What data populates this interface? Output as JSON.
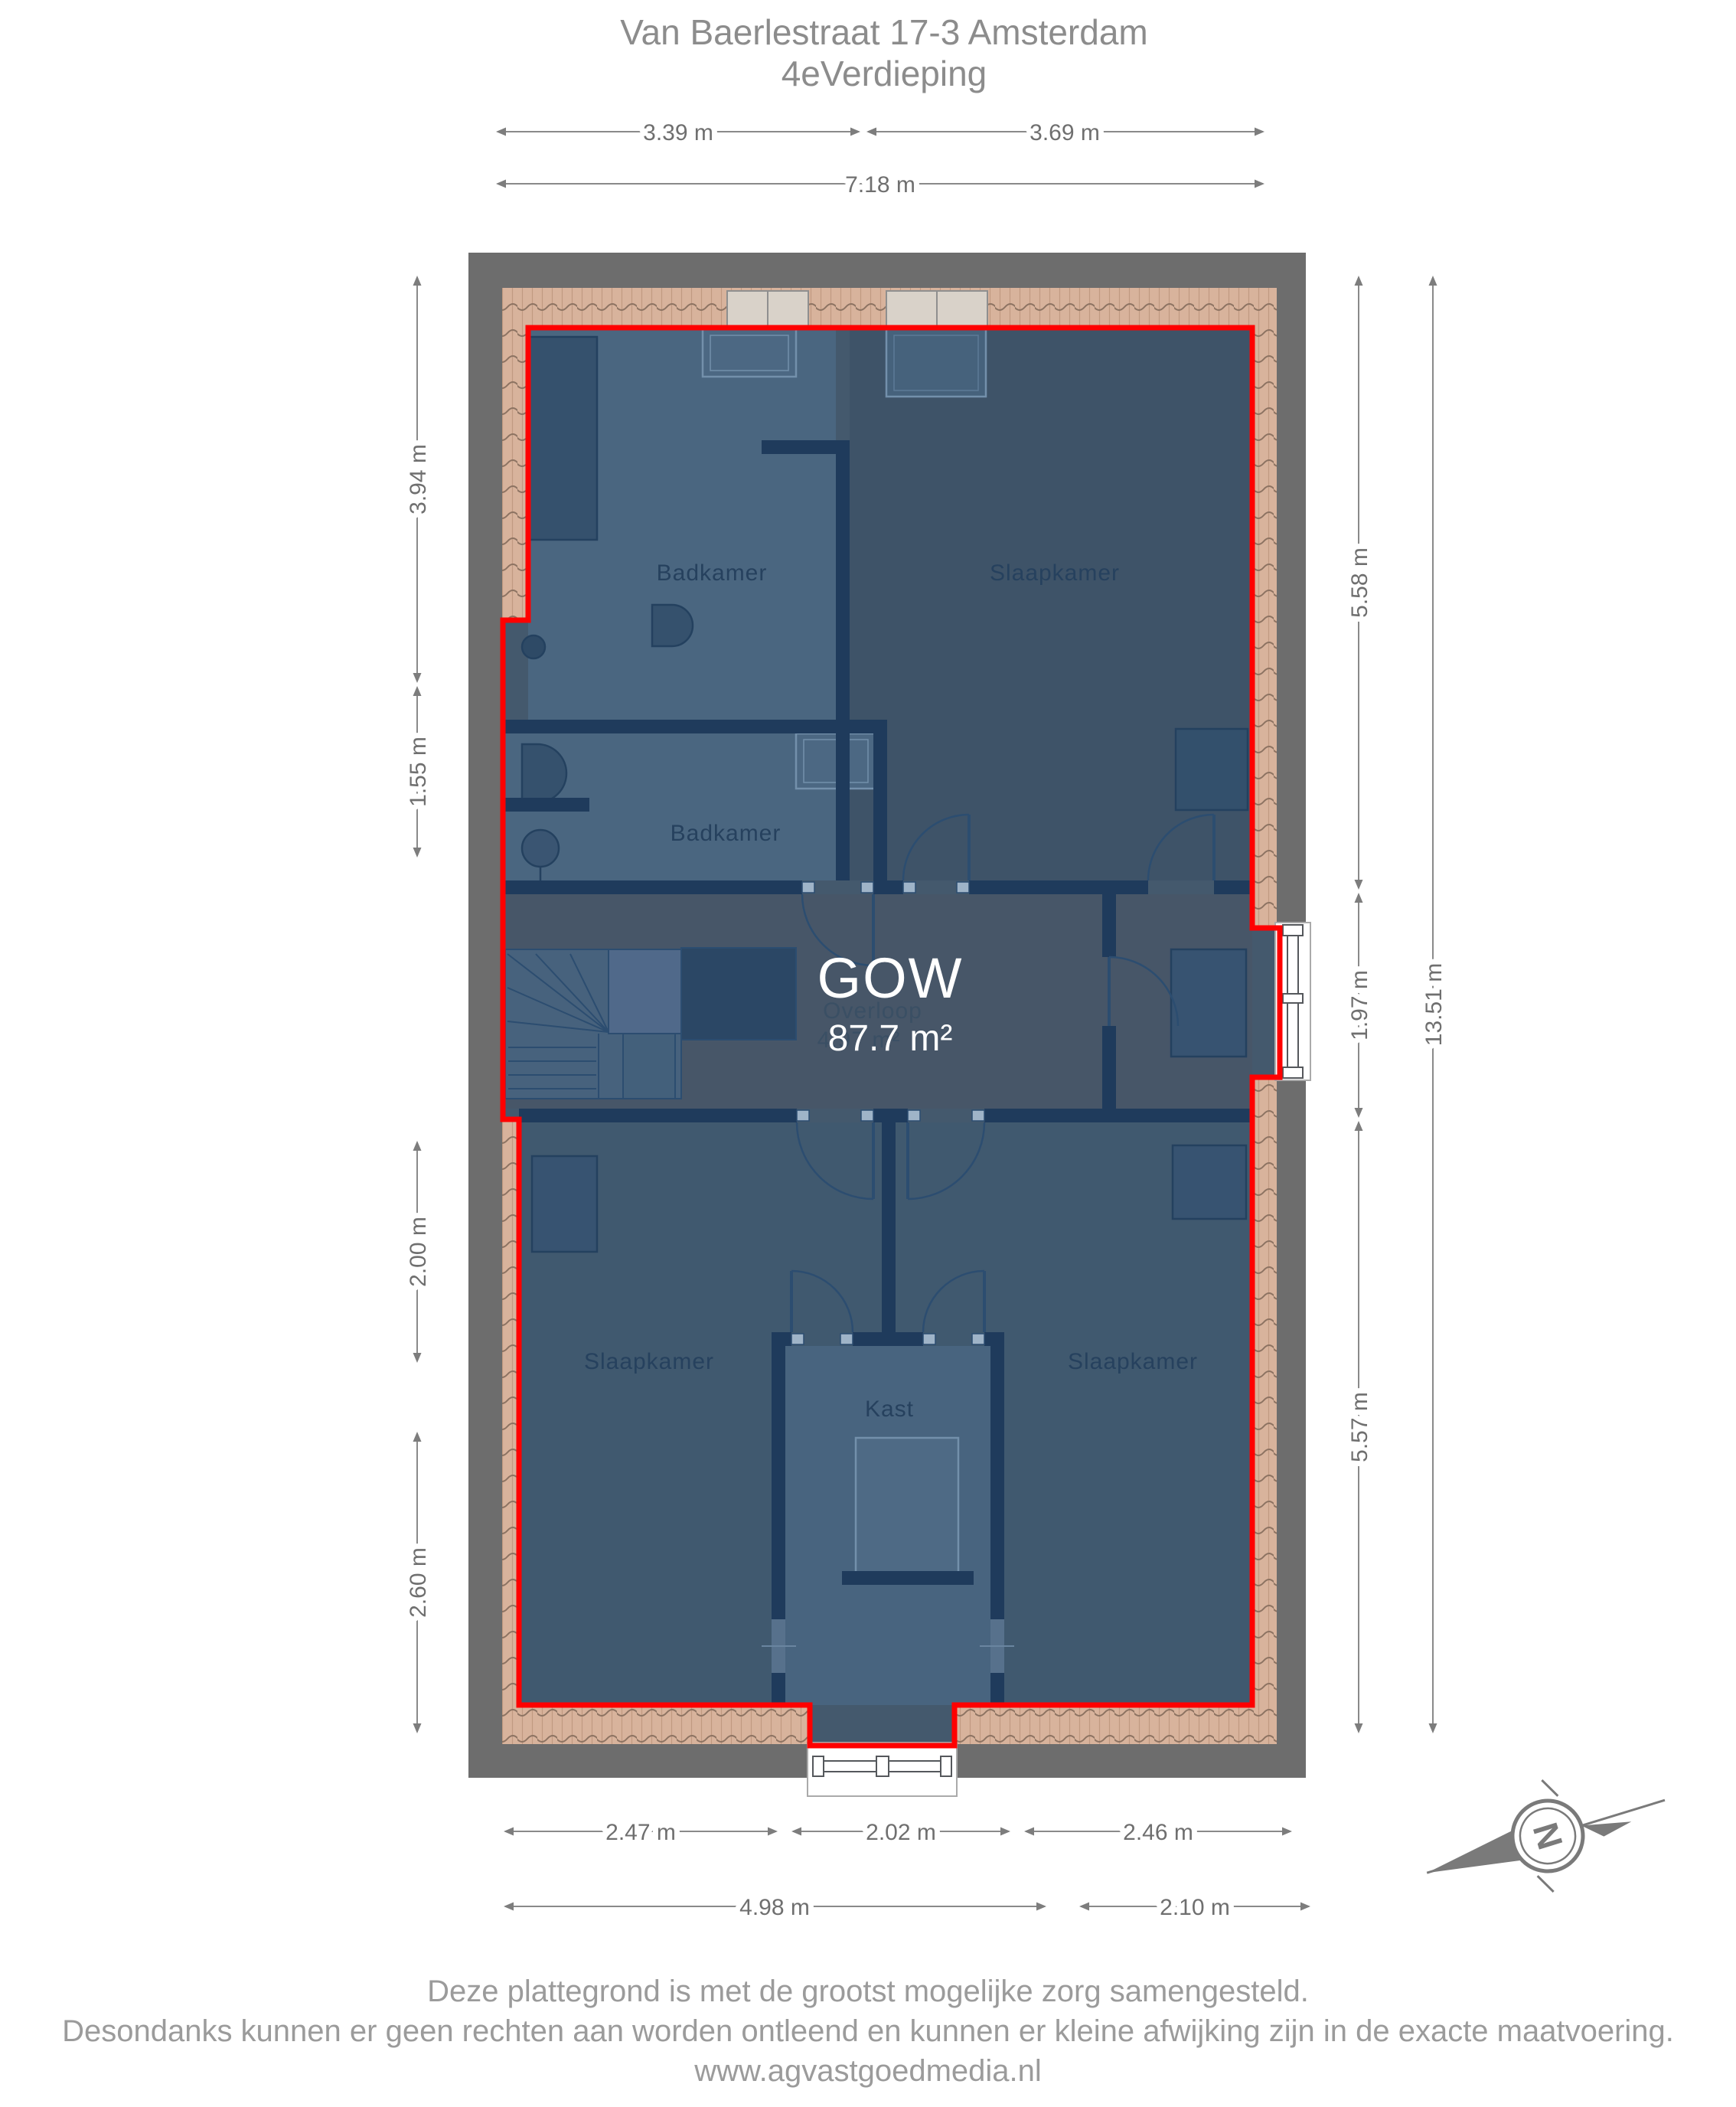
{
  "title": {
    "line1": "Van Baerlestraat 17-3 Amsterdam",
    "line2": "4eVerdieping"
  },
  "plan": {
    "gow_label": "GOW",
    "gow_area": "87.7 m²",
    "overloop_label": "Overloop",
    "overloop_area": "4.97 m²",
    "rooms": {
      "badkamer_top": "Badkamer",
      "badkamer_mid": "Badkamer",
      "slaapkamer_top": "Slaapkamer",
      "slaapkamer_left": "Slaapkamer",
      "slaapkamer_right": "Slaapkamer",
      "kast": "Kast"
    }
  },
  "dimensions": {
    "top": {
      "d1": "3.39 m",
      "d2": "3.69 m",
      "total": "7.18 m"
    },
    "left": {
      "d1": "3.94 m",
      "d2": "1.55 m",
      "d3": "2.00 m",
      "d4": "2.60 m"
    },
    "right": {
      "d1": "5.58 m",
      "d2": "1.97 m",
      "d3": "5.57 m",
      "total": "13.51 m"
    },
    "bottom": {
      "d1": "2.47 m",
      "d2": "2.02 m",
      "d3": "2.46 m",
      "t1": "4.98 m",
      "t2": "2.10 m"
    }
  },
  "compass": {
    "north_label": "N"
  },
  "footer": {
    "line1": "Deze plattegrond is met de grootst mogelijke zorg samengesteld.",
    "line2": "Desondanks kunnen er geen rechten aan worden ontleend en kunnen er kleine afwijking zijn in de exacte maatvoering.",
    "line3": "www.agvastgoedmedia.nl"
  },
  "colors": {
    "gow_outline": "#ff0000",
    "outer_wall": "#6d6d6d",
    "roof_tiles": "#d8b39c",
    "floor_base": "#44596d",
    "interior_wall": "#1f3b5c",
    "dimension_text": "#6f6f6f"
  }
}
